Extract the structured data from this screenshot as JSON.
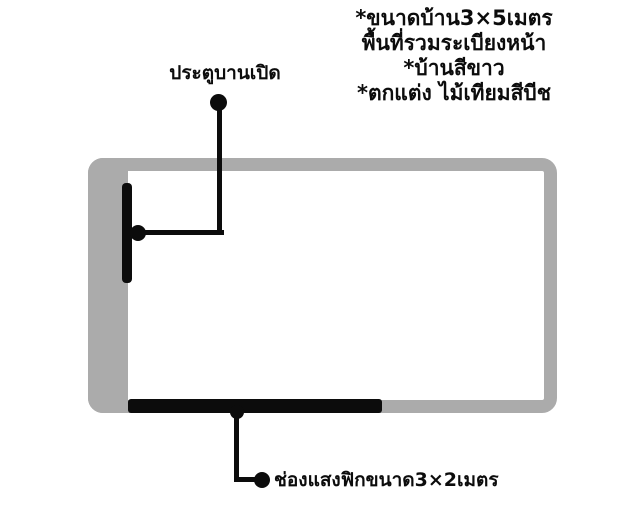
{
  "notes": {
    "lines": [
      "*ขนาดบ้าน3×5เมตร",
      "พื้นที่รวมระเบียงหน้า",
      "*บ้านสีขาว",
      "*ตกแต่ง ไม้เทียมสีบีช"
    ]
  },
  "labels": {
    "door": "ประตูบานเปิด",
    "light_opening": "ช่องแสงฟิกขนาด3×2เมตร"
  },
  "colors": {
    "wall": "#ababab",
    "ink": "#0c0c0c",
    "bg": "#ffffff"
  }
}
